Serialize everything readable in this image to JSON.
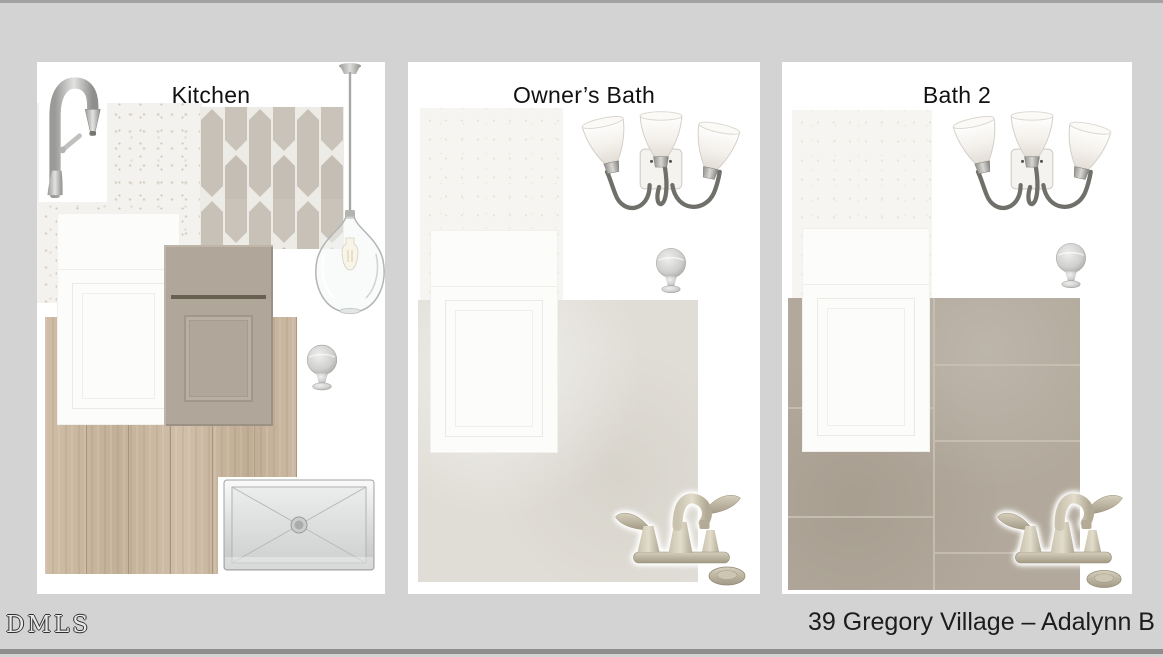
{
  "footer": {
    "watermark": "DMLS",
    "project_title": "39 Gregory Village – Adalynn B"
  },
  "boards": [
    {
      "title": "Kitchen",
      "items": [
        "brushed-nickel-pulldown-faucet",
        "white-quartz-countertop-swatch",
        "greige-picket-tile-backsplash-swatch",
        "clear-glass-pendant-light",
        "white-shaker-cabinet",
        "greige-shaker-base-cabinet",
        "light-oak-plank-flooring-swatch",
        "brushed-nickel-round-knob",
        "stainless-steel-undermount-sink"
      ]
    },
    {
      "title": "Owner’s Bath",
      "items": [
        "three-light-vanity-fixture",
        "white-quartz-countertop-swatch",
        "white-shaker-vanity-cabinet",
        "brushed-nickel-round-knob",
        "light-gray-tile-flooring-swatch",
        "brushed-nickel-centerset-faucet",
        "drain-stopper"
      ]
    },
    {
      "title": "Bath 2",
      "items": [
        "three-light-vanity-fixture",
        "white-quartz-countertop-swatch",
        "white-shaker-vanity-cabinet",
        "brushed-nickel-round-knob",
        "taupe-tile-flooring-swatch",
        "brushed-nickel-centerset-faucet",
        "drain-stopper"
      ]
    }
  ],
  "colors": {
    "page_background": "#d3d3d3",
    "panel_background": "#ffffff",
    "edge_strip_top": "#a2a2a2",
    "edge_strip_bottom": "#8d8d8d",
    "title_text": "#111111",
    "footer_text": "#1c1c1c",
    "quartz": "#f3f2ee",
    "picket_tile": "#c8c1b7",
    "tile_grout": "#edebe6",
    "white_cabinet": "#fcfcfb",
    "greige_cabinet": "#b0a69a",
    "wood_floor": "#cbb9a2",
    "owners_bath_tile": "#e0ddd6",
    "bath2_tile": "#b2a99c",
    "brushed_nickel": "#b9b9b9"
  }
}
